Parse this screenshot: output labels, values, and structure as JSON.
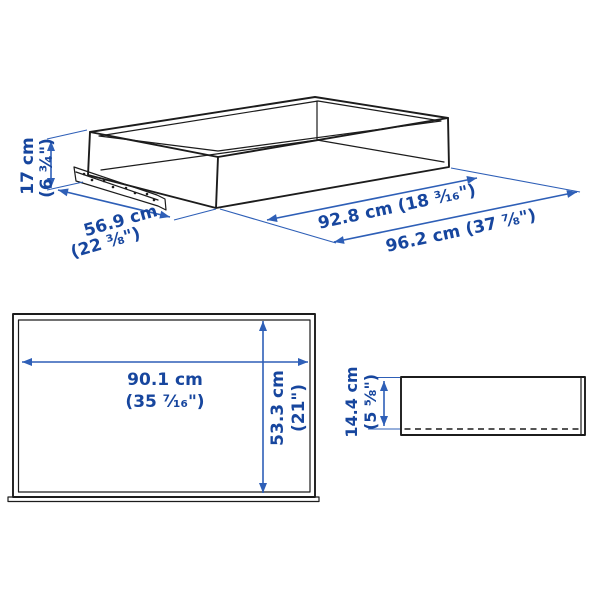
{
  "page": {
    "background": "#ffffff",
    "description_labels_language": "metric and imperial dimension labels"
  },
  "colors": {
    "artwork_line": "#1c1c1c",
    "dimension_text": "#17469e",
    "dimension_line": "#2e5fb7"
  },
  "isometric_view": {
    "height": {
      "cm": "17 cm",
      "inch": "(6 ¾\")"
    },
    "depth": {
      "cm": "56.9 cm",
      "inch": "(22 ⅜\")"
    },
    "inner_width": {
      "label": "92.8 cm (18 ³⁄₁₆\")"
    },
    "outer_width": {
      "label": "96.2 cm (37 ⅞\")"
    }
  },
  "front_view": {
    "width": {
      "cm": "90.1 cm",
      "inch": "(35 ⁷⁄₁₆\")"
    },
    "height": {
      "cm": "53.3 cm",
      "inch": "(21\")"
    }
  },
  "side_view": {
    "height": {
      "cm": "14.4 cm",
      "inch": "(5 ⅝\")"
    }
  }
}
